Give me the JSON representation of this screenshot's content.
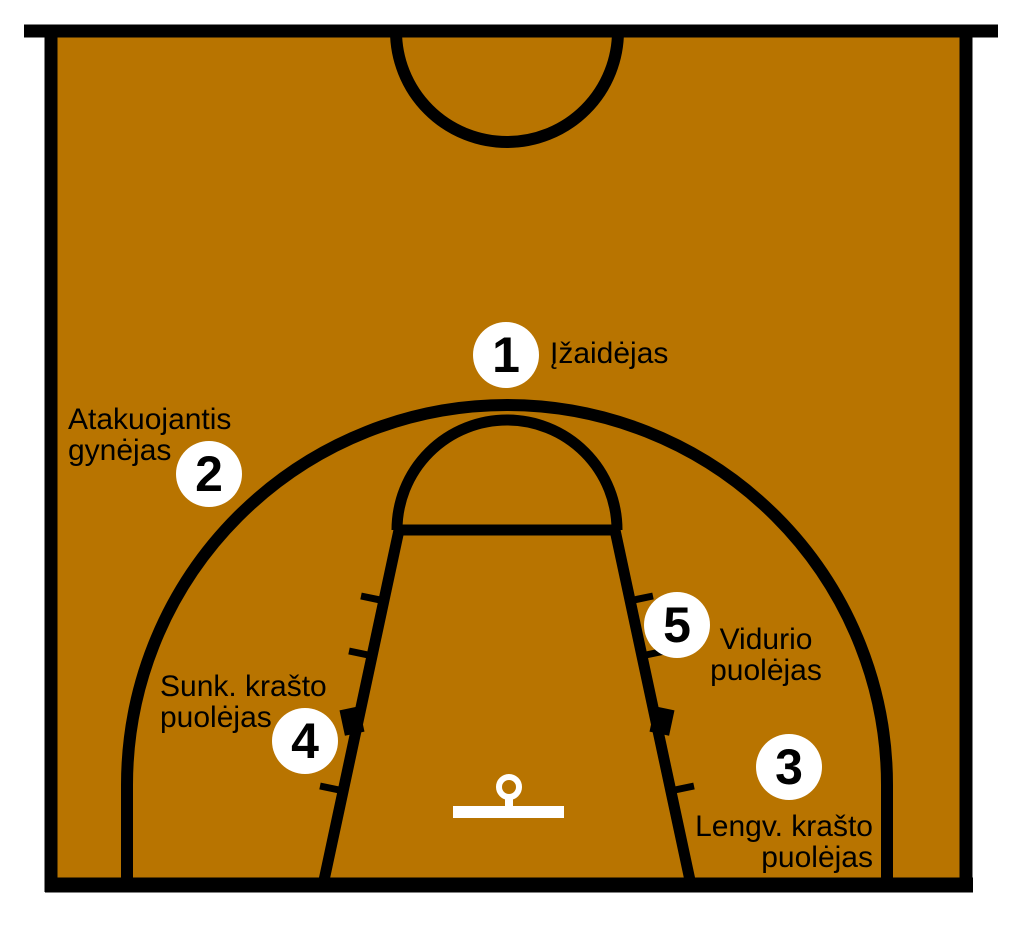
{
  "diagram_type": "basketball-half-court-positions",
  "positions": [
    {
      "number": "1",
      "label": "Įžaidėjas"
    },
    {
      "number": "2",
      "label_line1": "Atakuojantis",
      "label_line2": "gynėjas"
    },
    {
      "number": "3",
      "label_line1": "Lengv. krašto",
      "label_line2": "puolėjas"
    },
    {
      "number": "4",
      "label_line1": "Sunk. krašto",
      "label_line2": "puolėjas"
    },
    {
      "number": "5",
      "label_line1": "Vidurio",
      "label_line2": "puolėjas"
    }
  ],
  "colors": {
    "court": "#B87400",
    "lines": "#000000",
    "markings": "#FFFFFF",
    "text": "#000000",
    "marker_fill": "#FFFFFF"
  }
}
